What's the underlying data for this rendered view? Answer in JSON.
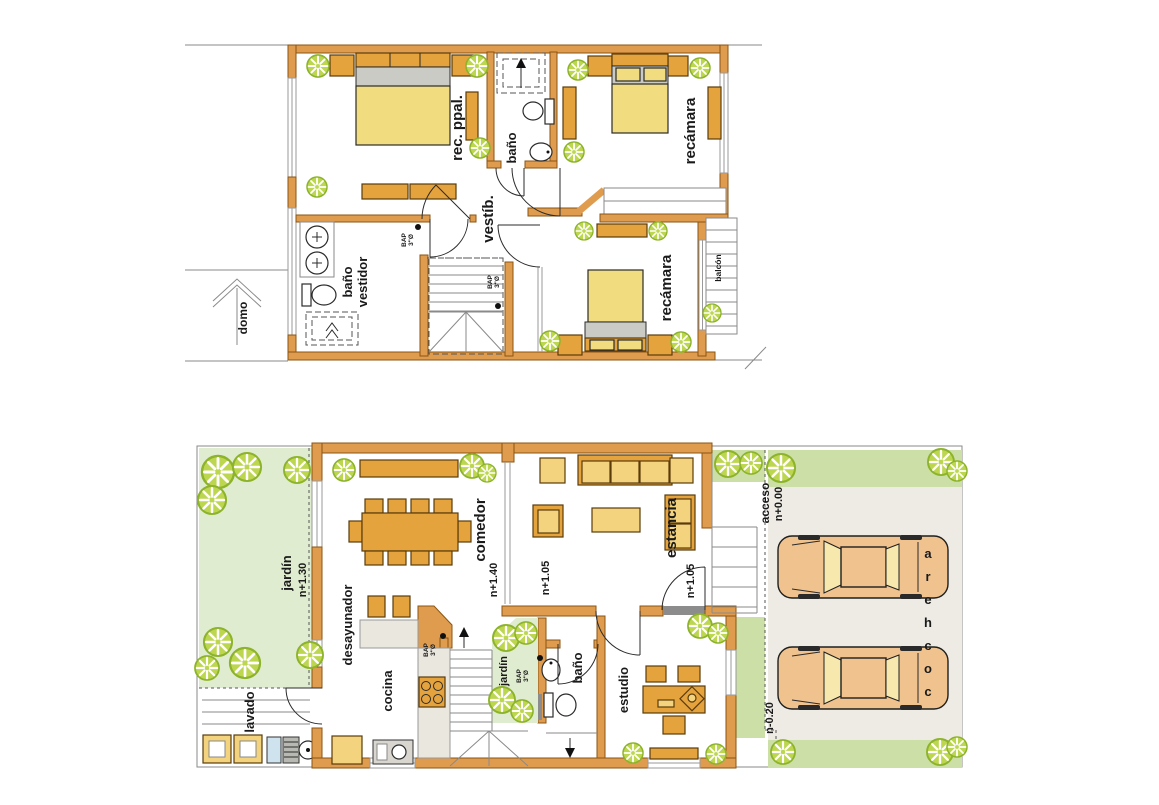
{
  "colors": {
    "wall": "#e09c4e",
    "wall_stroke": "#8a5513",
    "furniture": "#e5a33d",
    "furniture_light": "#f3d37e",
    "bed": "#f2dc80",
    "pillow": "#cbcbc5",
    "counter": "#eae7df",
    "grass_light": "#e0eccf",
    "grass_dark": "#cbdfa6",
    "garage_floor": "#edebe3",
    "tree_fill": "#bcd64f",
    "tree_stroke": "#8cb32b",
    "car_body": "#efc28e",
    "car_glass": "#f7e9ae",
    "ink": "#1a1a1a"
  },
  "upper_floor": {
    "label_master": "rec. ppal.",
    "label_bath": "baño",
    "label_bedroom_top": "recámara",
    "label_vestibule": "vestíb.",
    "label_bath_dressing_1": "baño",
    "label_bath_dressing_2": "vestidor",
    "label_bedroom_bottom": "recámara",
    "label_balcony": "balcón",
    "label_skylight": "domo",
    "bap_1": "BAP",
    "bap_2": "3\"Ø"
  },
  "lower_floor": {
    "label_garden": "jardín",
    "level_garden": "n+1.30",
    "label_laundry": "lavado",
    "label_breakfast": "desayunador",
    "label_kitchen": "cocina",
    "label_dining": "comedor",
    "level_dining": "n+1.40",
    "label_living": "estancia",
    "level_living": "n+1.05",
    "level_hall": "n+1.05",
    "label_inner_garden": "jardín",
    "label_bath": "baño",
    "label_study": "estudio",
    "label_access": "acceso",
    "level_access": "n+0.00",
    "level_garage": "n-0.20",
    "label_garage": "cochera",
    "bap_1": "BAP",
    "bap_2": "3\"Ø"
  }
}
